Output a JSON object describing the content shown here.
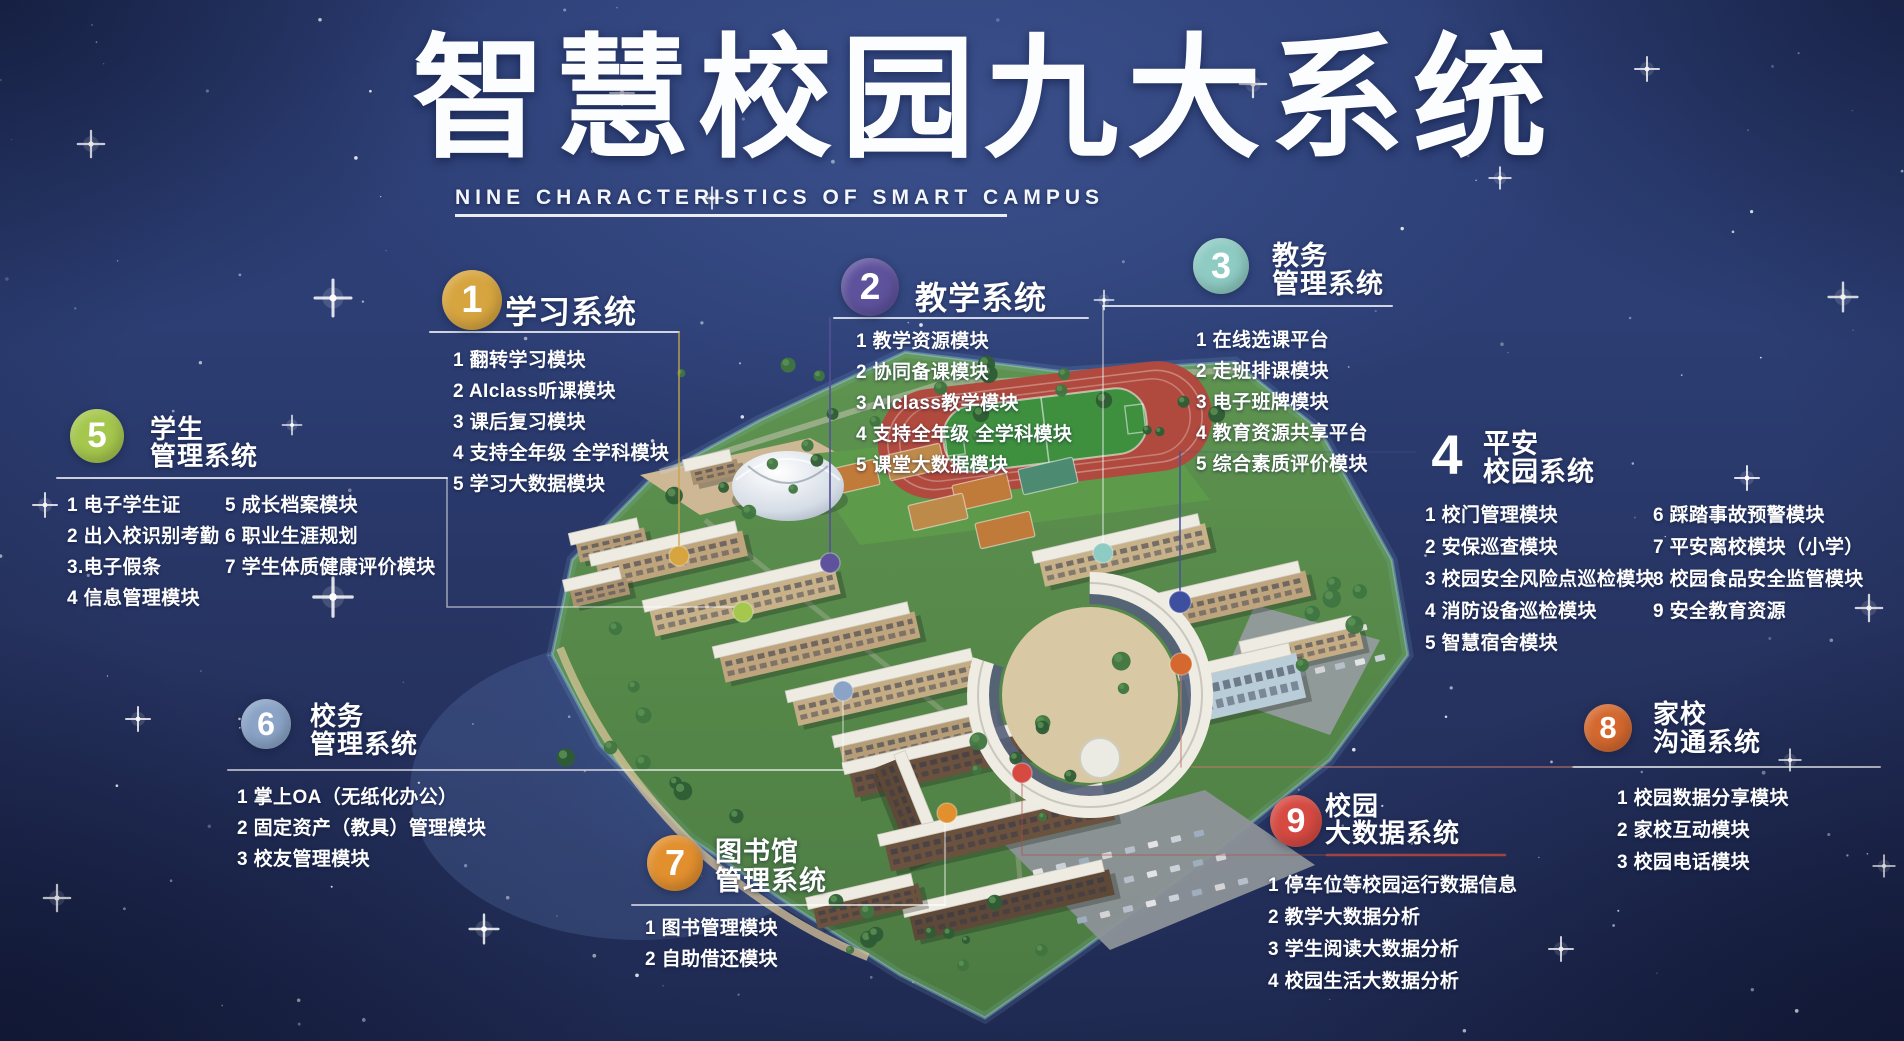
{
  "title": {
    "main": "智慧校园九大系统",
    "subtitle": "NINE CHARACTERISTICS OF SMART CAMPUS"
  },
  "systems": [
    {
      "number": "1",
      "name": [
        "学习系统"
      ],
      "color": "#d7a53f",
      "modules": [
        "1 翻转学习模块",
        "2 AIclass听课模块",
        "3 课后复习模块",
        "4 支持全年级 全学科模块",
        "5 学习大数据模块"
      ]
    },
    {
      "number": "2",
      "name": [
        "教学系统"
      ],
      "color": "#5f529d",
      "modules": [
        "1 教学资源模块",
        "2 协同备课模块",
        "3 AIclass教学模块",
        "4 支持全年级 全学科模块",
        "5 课堂大数据模块"
      ]
    },
    {
      "number": "3",
      "name": [
        "教务",
        "管理系统"
      ],
      "color": "#8ecbc3",
      "modules": [
        "1 在线选课平台",
        "2 走班排课模块",
        "3 电子班牌模块",
        "4 教育资源共享平台",
        "5 综合素质评价模块"
      ]
    },
    {
      "number": "4",
      "name": [
        "平安",
        "校园系统"
      ],
      "color": "#3d4f9e",
      "badge_style": "plain",
      "modules_left": [
        "1 校门管理模块",
        "2 安保巡查模块",
        "3 校园安全风险点巡检模块",
        "4 消防设备巡检模块",
        "5 智慧宿舍模块"
      ],
      "modules_right": [
        "6 踩踏事故预警模块",
        "7 平安离校模块（小学）",
        "8 校园食品安全监管模块",
        "9 安全教育资源"
      ]
    },
    {
      "number": "5",
      "name": [
        "学生",
        "管理系统"
      ],
      "color": "#a5c74d",
      "modules_left": [
        "1 电子学生证",
        "2 出入校识别考勤",
        "3.电子假条",
        "4 信息管理模块"
      ],
      "modules_right": [
        "5 成长档案模块",
        "6 职业生涯规划",
        "7 学生体质健康评价模块"
      ]
    },
    {
      "number": "6",
      "name": [
        "校务",
        "管理系统"
      ],
      "color": "#8aa3c6",
      "modules": [
        "1 掌上OA（无纸化办公）",
        "2 固定资产（教具）管理模块",
        "3 校友管理模块"
      ]
    },
    {
      "number": "7",
      "name": [
        "图书馆",
        "管理系统"
      ],
      "color": "#e28f2e",
      "modules": [
        "1 图书管理模块",
        "2 自助借还模块"
      ]
    },
    {
      "number": "8",
      "name": [
        "家校",
        "沟通系统"
      ],
      "color": "#d4682e",
      "modules": [
        "1 校园数据分享模块",
        "2 家校互动模块",
        "3 校园电话模块"
      ]
    },
    {
      "number": "9",
      "name": [
        "校园",
        "大数据系统"
      ],
      "color": "#d64a42",
      "modules": [
        "1 停车位等校园运行数据信息",
        "2 教学大数据分析",
        "3 学生阅读大数据分析",
        "4 校园生活大数据分析"
      ]
    }
  ]
}
